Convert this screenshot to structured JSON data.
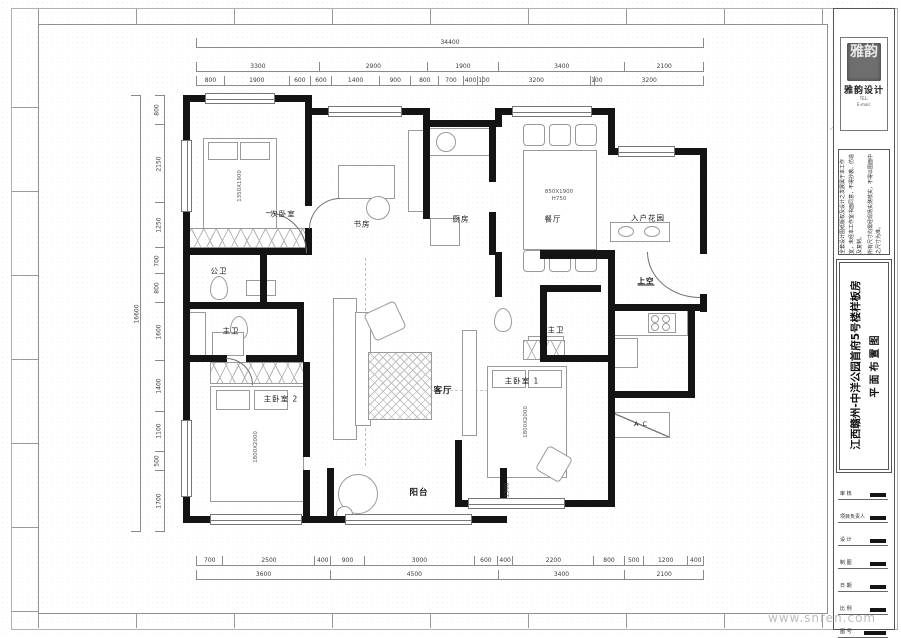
{
  "watermark": "www.snren.com",
  "dims": {
    "top_overall": "34400",
    "top_row2": [
      "3300",
      "2900",
      "1900",
      "3400",
      "2100"
    ],
    "top_row3": [
      "800",
      "1900",
      "600",
      "600",
      "1400",
      "900",
      "800",
      "700",
      "400",
      "100",
      "3200",
      "100",
      "3200"
    ],
    "bottom_row1": [
      "700",
      "2500",
      "400",
      "900",
      "3000",
      "600",
      "400",
      "2200",
      "800",
      "500",
      "1200",
      "400"
    ],
    "bottom_row2": [
      "3600",
      "4500",
      "3400",
      "2100"
    ],
    "left_overall": "16600",
    "left_col": [
      "800",
      "2150",
      "1250",
      "700",
      "800",
      "1600",
      "1400",
      "1100",
      "500",
      "1700"
    ],
    "balcony_depth": "1500"
  },
  "rooms": {
    "bedroom2": "次卧室",
    "study": "书房",
    "kitchen": "厨房",
    "dining": "餐厅",
    "entry_garden": "入户花园",
    "public_bath": "公卫",
    "master_bath_left": "主卫",
    "master_bath_right": "主卫",
    "master_bedroom2": "主卧室 2",
    "master_bedroom1": "主卧室 1",
    "living": "客厅",
    "balcony": "阳台",
    "void_above": "上空",
    "ac_platform": "A C"
  },
  "furniture": {
    "bed2_size": "1350X1900",
    "bed_m2_size": "1800X2000",
    "bed_m1_size": "1800X2000",
    "table_size": "850X1900",
    "table_height": "H750"
  },
  "titleblock": {
    "seal_text": "雅韵",
    "brand": "雅韵设计",
    "contact1": "TEL:",
    "contact2": "E-mail:",
    "notes1": "全套设计图纸版权及设计之发展属于本工作室，未经本工作室书面同意，不得抄袭、仿造及复制。",
    "notes2": "所有尺寸均需经现场实测核实，不得以图面中之尺寸为准。",
    "project": "江西赣州-中洋公园首府5号楼样板房",
    "drawing": "平面布置图",
    "rows": [
      {
        "label": "审 核"
      },
      {
        "label": "项目负责人"
      },
      {
        "label": "设 计"
      },
      {
        "label": "制 图"
      },
      {
        "label": "日 期"
      },
      {
        "label": "比 例"
      },
      {
        "label": "图 号"
      }
    ]
  }
}
